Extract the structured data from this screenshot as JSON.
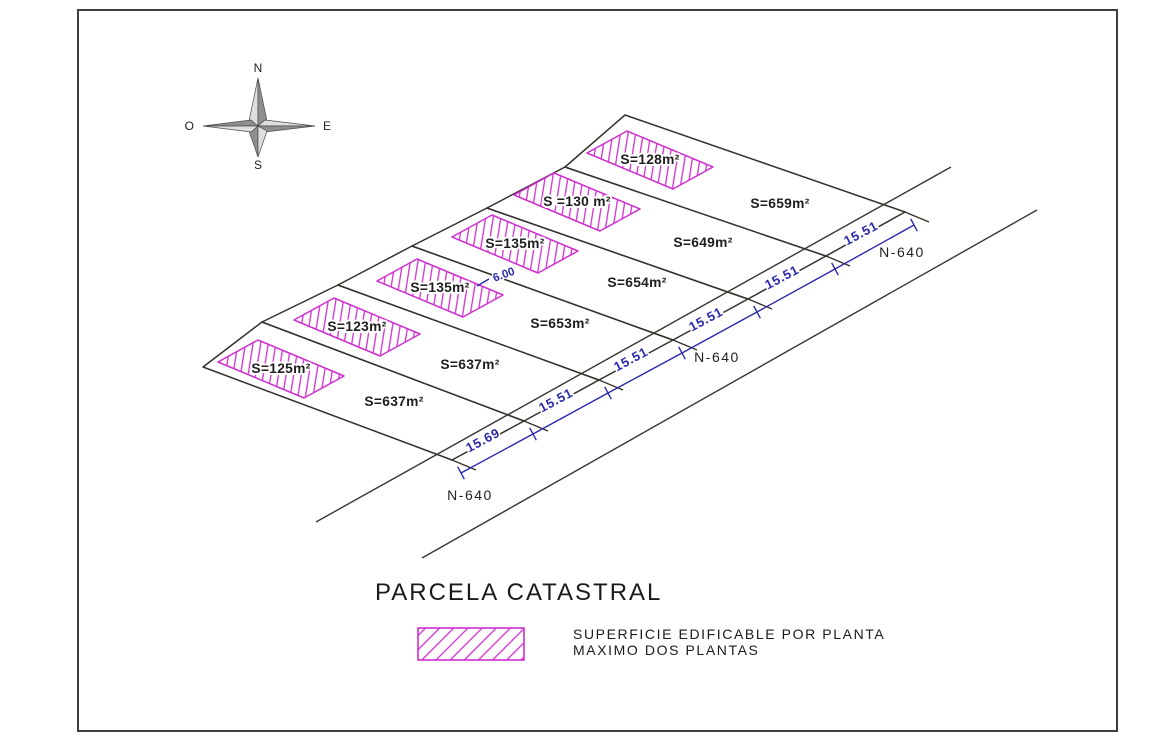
{
  "colors": {
    "parcel_line": "#35302a",
    "hatch_magenta": "#cf2fcf",
    "dimension_blue": "#2929ad",
    "label_text": "#1e1e1e",
    "road_line": "#3a352f",
    "compass_dark": "#8f8f8f",
    "compass_light": "#dedede",
    "border": "#3f3f3f",
    "halo": "#ffffff"
  },
  "border": {
    "x": 78,
    "y": 10,
    "w": 1039,
    "h": 721
  },
  "compass": {
    "center": [
      258,
      126
    ],
    "tips": {
      "n": [
        258,
        78
      ],
      "s": [
        258,
        157
      ],
      "w": [
        203,
        126
      ],
      "e": [
        315,
        126
      ]
    },
    "waist": {
      "n": [
        [
          249,
          121
        ],
        [
          267,
          121
        ]
      ],
      "s": [
        [
          249,
          131
        ],
        [
          267,
          131
        ]
      ],
      "w": [
        [
          251,
          120
        ],
        [
          251,
          132
        ]
      ],
      "e": [
        [
          265,
          120
        ],
        [
          265,
          132
        ]
      ]
    },
    "labels": {
      "north": "N",
      "south": "S",
      "east": "E",
      "west": "O"
    },
    "label_positions": {
      "north": [
        258,
        72
      ],
      "south": [
        258,
        169
      ],
      "east": [
        323,
        130
      ],
      "west": [
        194,
        130
      ]
    }
  },
  "plan": {
    "nw_points": [
      [
        203,
        367
      ],
      [
        262,
        322
      ],
      [
        338,
        285
      ],
      [
        412,
        246
      ],
      [
        487,
        208
      ],
      [
        565,
        167
      ],
      [
        625,
        115
      ]
    ],
    "frontage_points": [
      [
        452,
        460
      ],
      [
        524,
        421
      ],
      [
        599,
        380
      ],
      [
        673,
        340
      ],
      [
        748,
        299
      ],
      [
        826,
        256
      ],
      [
        905,
        212
      ]
    ],
    "division_extension": [
      24,
      10
    ],
    "parcels": [
      {
        "area_label": "S=637m²",
        "label_pos": [
          394,
          406
        ]
      },
      {
        "area_label": "S=637m²",
        "label_pos": [
          470,
          369
        ]
      },
      {
        "area_label": "S=653m²",
        "label_pos": [
          560,
          328
        ]
      },
      {
        "area_label": "S=654m²",
        "label_pos": [
          637,
          287
        ]
      },
      {
        "area_label": "S=649m²",
        "label_pos": [
          703,
          247
        ]
      },
      {
        "area_label": "S=659m²",
        "label_pos": [
          780,
          208
        ]
      }
    ],
    "buildable_areas": [
      {
        "label": "S=125m²",
        "center": [
          281,
          369
        ]
      },
      {
        "label": "S=123m²",
        "center": [
          357,
          327
        ]
      },
      {
        "label": "S=135m²",
        "center": [
          440,
          288
        ]
      },
      {
        "label": "S=135m²",
        "center": [
          515,
          244
        ]
      },
      {
        "label": "S =130 m²",
        "center": [
          577,
          202
        ]
      },
      {
        "label": "S=128m²",
        "center": [
          650,
          160
        ]
      }
    ],
    "buildable_halfaxes": {
      "u": [
        20,
        -11
      ],
      "v": [
        43,
        18
      ]
    }
  },
  "dimensions": {
    "blue_offset": [
      9,
      13
    ],
    "labels": [
      "15.69",
      "15.51",
      "15.51",
      "15.51",
      "15.51",
      "15.51"
    ],
    "label_positions": [
      [
        485,
        444
      ],
      [
        558,
        404
      ],
      [
        633,
        363
      ],
      [
        708,
        323
      ],
      [
        784,
        281
      ],
      [
        863,
        237
      ]
    ],
    "label_angle": -28,
    "extra": {
      "text": "6.00",
      "pos": [
        505,
        278
      ],
      "tick": [
        [
          477,
          286
        ],
        [
          489,
          279
        ]
      ]
    }
  },
  "roads": {
    "name": "N-640",
    "near_line": [
      [
        316,
        522
      ],
      [
        951,
        167
      ]
    ],
    "far_line": [
      [
        422,
        558
      ],
      [
        1037,
        210
      ]
    ],
    "labels": [
      {
        "text": "N-640",
        "pos": [
          902,
          257
        ]
      },
      {
        "text": "N-640",
        "pos": [
          717,
          362
        ]
      },
      {
        "text": "N-640",
        "pos": [
          470,
          500
        ]
      }
    ]
  },
  "legend": {
    "title": "PARCELA CATASTRAL",
    "title_pos": [
      375,
      600
    ],
    "swatch": {
      "x": 418,
      "y": 628,
      "w": 106,
      "h": 32
    },
    "description_line1": "SUPERFICIE EDIFICABLE POR PLANTA",
    "description_line2": "MAXIMO DOS PLANTAS",
    "description_pos": [
      573,
      639
    ],
    "description_line_gap": 16
  }
}
